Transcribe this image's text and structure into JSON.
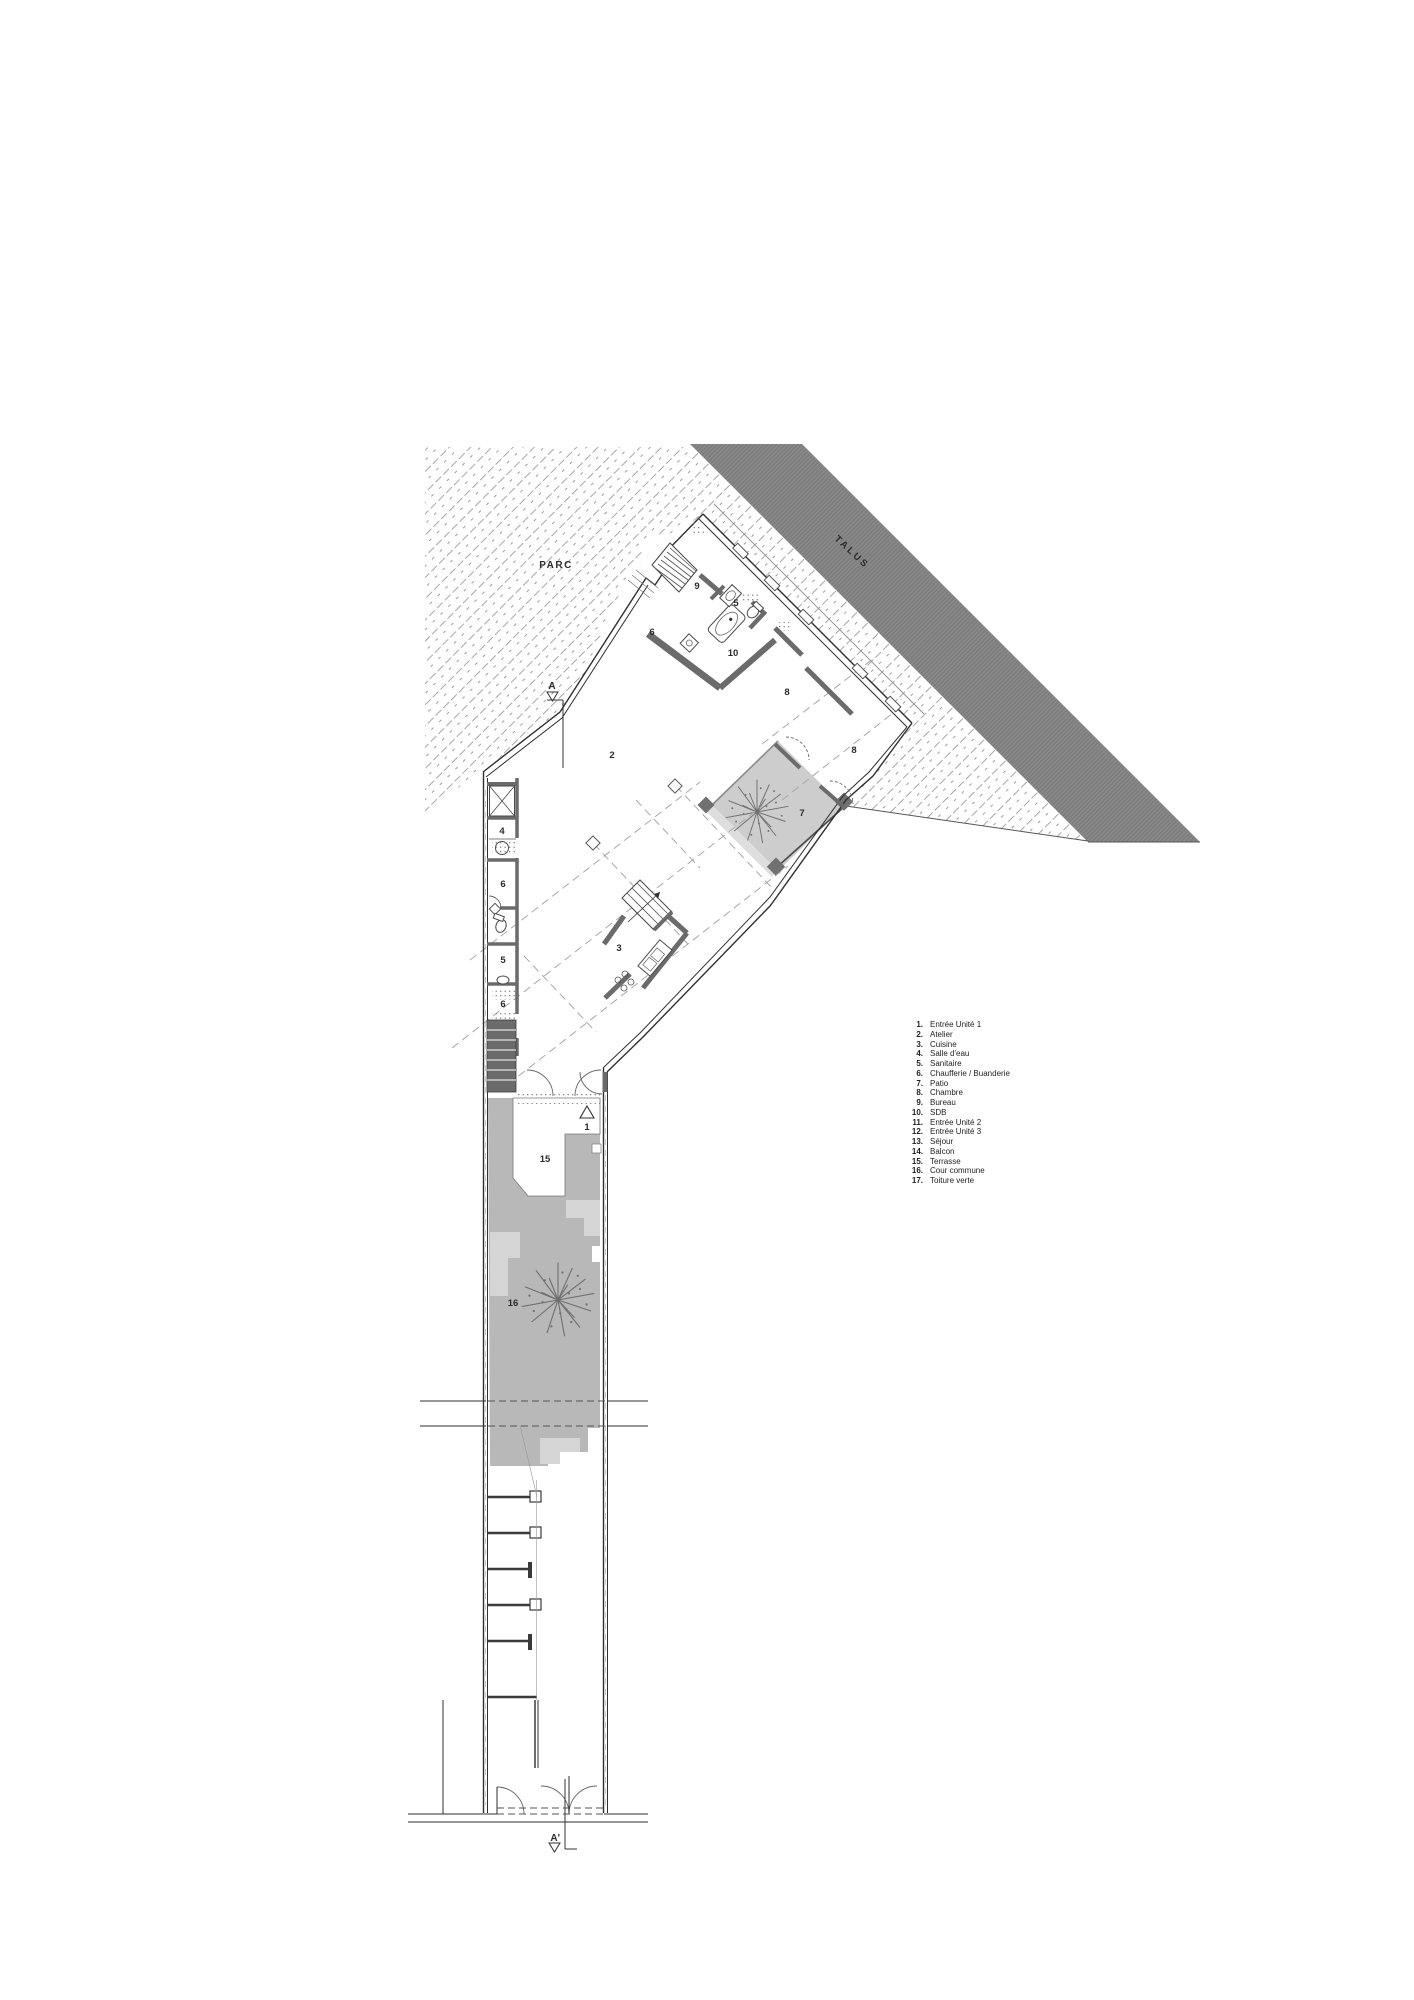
{
  "page": {
    "background": "#ffffff",
    "width": 1414,
    "height": 2000
  },
  "labels": {
    "parc": "PARC",
    "talus": "TALUS",
    "section_start": "A",
    "section_end": "A'"
  },
  "plan": {
    "rooms": [
      {
        "n": "9"
      },
      {
        "n": "5"
      },
      {
        "n": "6"
      },
      {
        "n": "10"
      },
      {
        "n": "8"
      },
      {
        "n": "8"
      },
      {
        "n": "2"
      },
      {
        "n": "7"
      },
      {
        "n": "4"
      },
      {
        "n": "6"
      },
      {
        "n": "5"
      },
      {
        "n": "6"
      },
      {
        "n": "3"
      },
      {
        "n": "1"
      },
      {
        "n": "15"
      },
      {
        "n": "16"
      }
    ]
  },
  "legend": {
    "items": [
      {
        "num": "1.",
        "label": "Entrée Unité 1"
      },
      {
        "num": "2.",
        "label": "Atelier"
      },
      {
        "num": "3.",
        "label": "Cuisine"
      },
      {
        "num": "4.",
        "label": "Salle d'eau"
      },
      {
        "num": "5.",
        "label": "Sanitaire"
      },
      {
        "num": "6.",
        "label": "Chaufferie / Buanderie"
      },
      {
        "num": "7.",
        "label": "Patio"
      },
      {
        "num": "8.",
        "label": "Chambre"
      },
      {
        "num": "9.",
        "label": "Bureau"
      },
      {
        "num": "10.",
        "label": "SDB"
      },
      {
        "num": "11.",
        "label": "Entrée Unité 2"
      },
      {
        "num": "12.",
        "label": "Entrée Unité 3"
      },
      {
        "num": "13.",
        "label": "Séjour"
      },
      {
        "num": "14.",
        "label": "Balcon"
      },
      {
        "num": "15.",
        "label": "Terrasse"
      },
      {
        "num": "16.",
        "label": "Cour commune"
      },
      {
        "num": "17.",
        "label": "Toiture verte"
      }
    ]
  },
  "colors": {
    "talus_band": "#7d7d7d",
    "hatch_line": "#9c9c9c",
    "wall_dark": "#2f2f2f",
    "wall_poche": "#6b6b6b",
    "patio_fill": "#cdcdcd",
    "courtyard_fill": "#b8b8b8",
    "courtyard_light": "#d5d5d5",
    "tree_stroke": "#6f6f6f",
    "dash_line": "#a8a8a8",
    "text": "#2b2b2b"
  }
}
